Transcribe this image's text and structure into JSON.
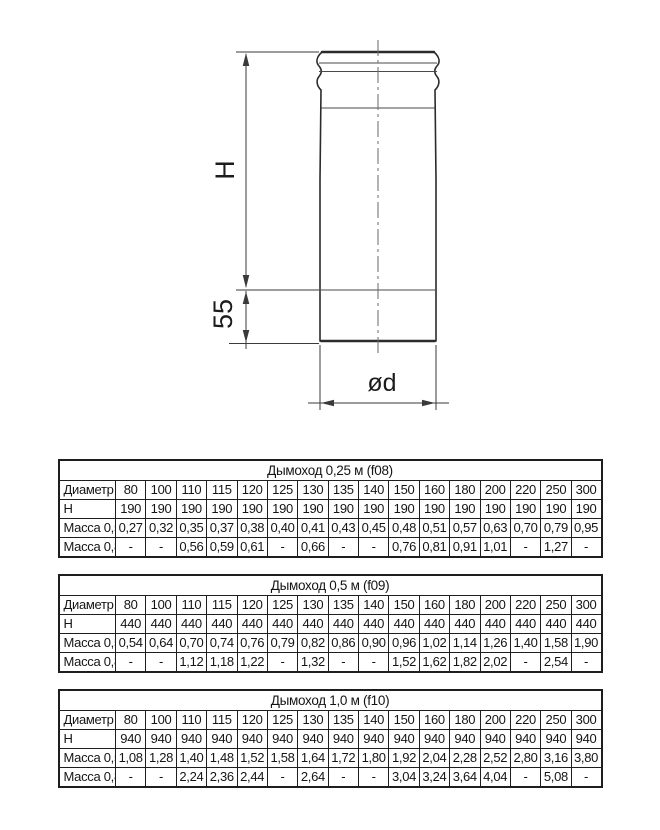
{
  "drawing": {
    "labels": {
      "height": "H",
      "bottom_section": "55",
      "diameter": "ød"
    }
  },
  "tables": [
    {
      "title": "Дымоход 0,25 м (f08)",
      "header_col": "Диаметр",
      "columns": [
        "80",
        "100",
        "110",
        "115",
        "120",
        "125",
        "130",
        "135",
        "140",
        "150",
        "160",
        "180",
        "200",
        "220",
        "250",
        "300"
      ],
      "rows": [
        {
          "label": "H",
          "values": [
            "190",
            "190",
            "190",
            "190",
            "190",
            "190",
            "190",
            "190",
            "190",
            "190",
            "190",
            "190",
            "190",
            "190",
            "190",
            "190"
          ]
        },
        {
          "label": "Масса 0,5",
          "values": [
            "0,27",
            "0,32",
            "0,35",
            "0,37",
            "0,38",
            "0,40",
            "0,41",
            "0,43",
            "0,45",
            "0,48",
            "0,51",
            "0,57",
            "0,63",
            "0,70",
            "0,79",
            "0,95"
          ]
        },
        {
          "label": "Масса 0,8",
          "values": [
            "-",
            "-",
            "0,56",
            "0,59",
            "0,61",
            "-",
            "0,66",
            "-",
            "-",
            "0,76",
            "0,81",
            "0,91",
            "1,01",
            "-",
            "1,27",
            "-"
          ]
        }
      ]
    },
    {
      "title": "Дымоход 0,5 м (f09)",
      "header_col": "Диаметр",
      "columns": [
        "80",
        "100",
        "110",
        "115",
        "120",
        "125",
        "130",
        "135",
        "140",
        "150",
        "160",
        "180",
        "200",
        "220",
        "250",
        "300"
      ],
      "rows": [
        {
          "label": "H",
          "values": [
            "440",
            "440",
            "440",
            "440",
            "440",
            "440",
            "440",
            "440",
            "440",
            "440",
            "440",
            "440",
            "440",
            "440",
            "440",
            "440"
          ]
        },
        {
          "label": "Масса 0,5",
          "values": [
            "0,54",
            "0,64",
            "0,70",
            "0,74",
            "0,76",
            "0,79",
            "0,82",
            "0,86",
            "0,90",
            "0,96",
            "1,02",
            "1,14",
            "1,26",
            "1,40",
            "1,58",
            "1,90"
          ]
        },
        {
          "label": "Масса 0,8",
          "values": [
            "-",
            "-",
            "1,12",
            "1,18",
            "1,22",
            "-",
            "1,32",
            "-",
            "-",
            "1,52",
            "1,62",
            "1,82",
            "2,02",
            "-",
            "2,54",
            "-"
          ]
        }
      ]
    },
    {
      "title": "Дымоход 1,0 м (f10)",
      "header_col": "Диаметр",
      "columns": [
        "80",
        "100",
        "110",
        "115",
        "120",
        "125",
        "130",
        "135",
        "140",
        "150",
        "160",
        "180",
        "200",
        "220",
        "250",
        "300"
      ],
      "rows": [
        {
          "label": "H",
          "values": [
            "940",
            "940",
            "940",
            "940",
            "940",
            "940",
            "940",
            "940",
            "940",
            "940",
            "940",
            "940",
            "940",
            "940",
            "940",
            "940"
          ]
        },
        {
          "label": "Масса 0,5",
          "values": [
            "1,08",
            "1,28",
            "1,40",
            "1,48",
            "1,52",
            "1,58",
            "1,64",
            "1,72",
            "1,80",
            "1,92",
            "2,04",
            "2,28",
            "2,52",
            "2,80",
            "3,16",
            "3,80"
          ]
        },
        {
          "label": "Масса 0,8",
          "values": [
            "-",
            "-",
            "2,24",
            "2,36",
            "2,44",
            "-",
            "2,64",
            "-",
            "-",
            "3,04",
            "3,24",
            "3,64",
            "4,04",
            "-",
            "5,08",
            "-"
          ]
        }
      ]
    }
  ]
}
